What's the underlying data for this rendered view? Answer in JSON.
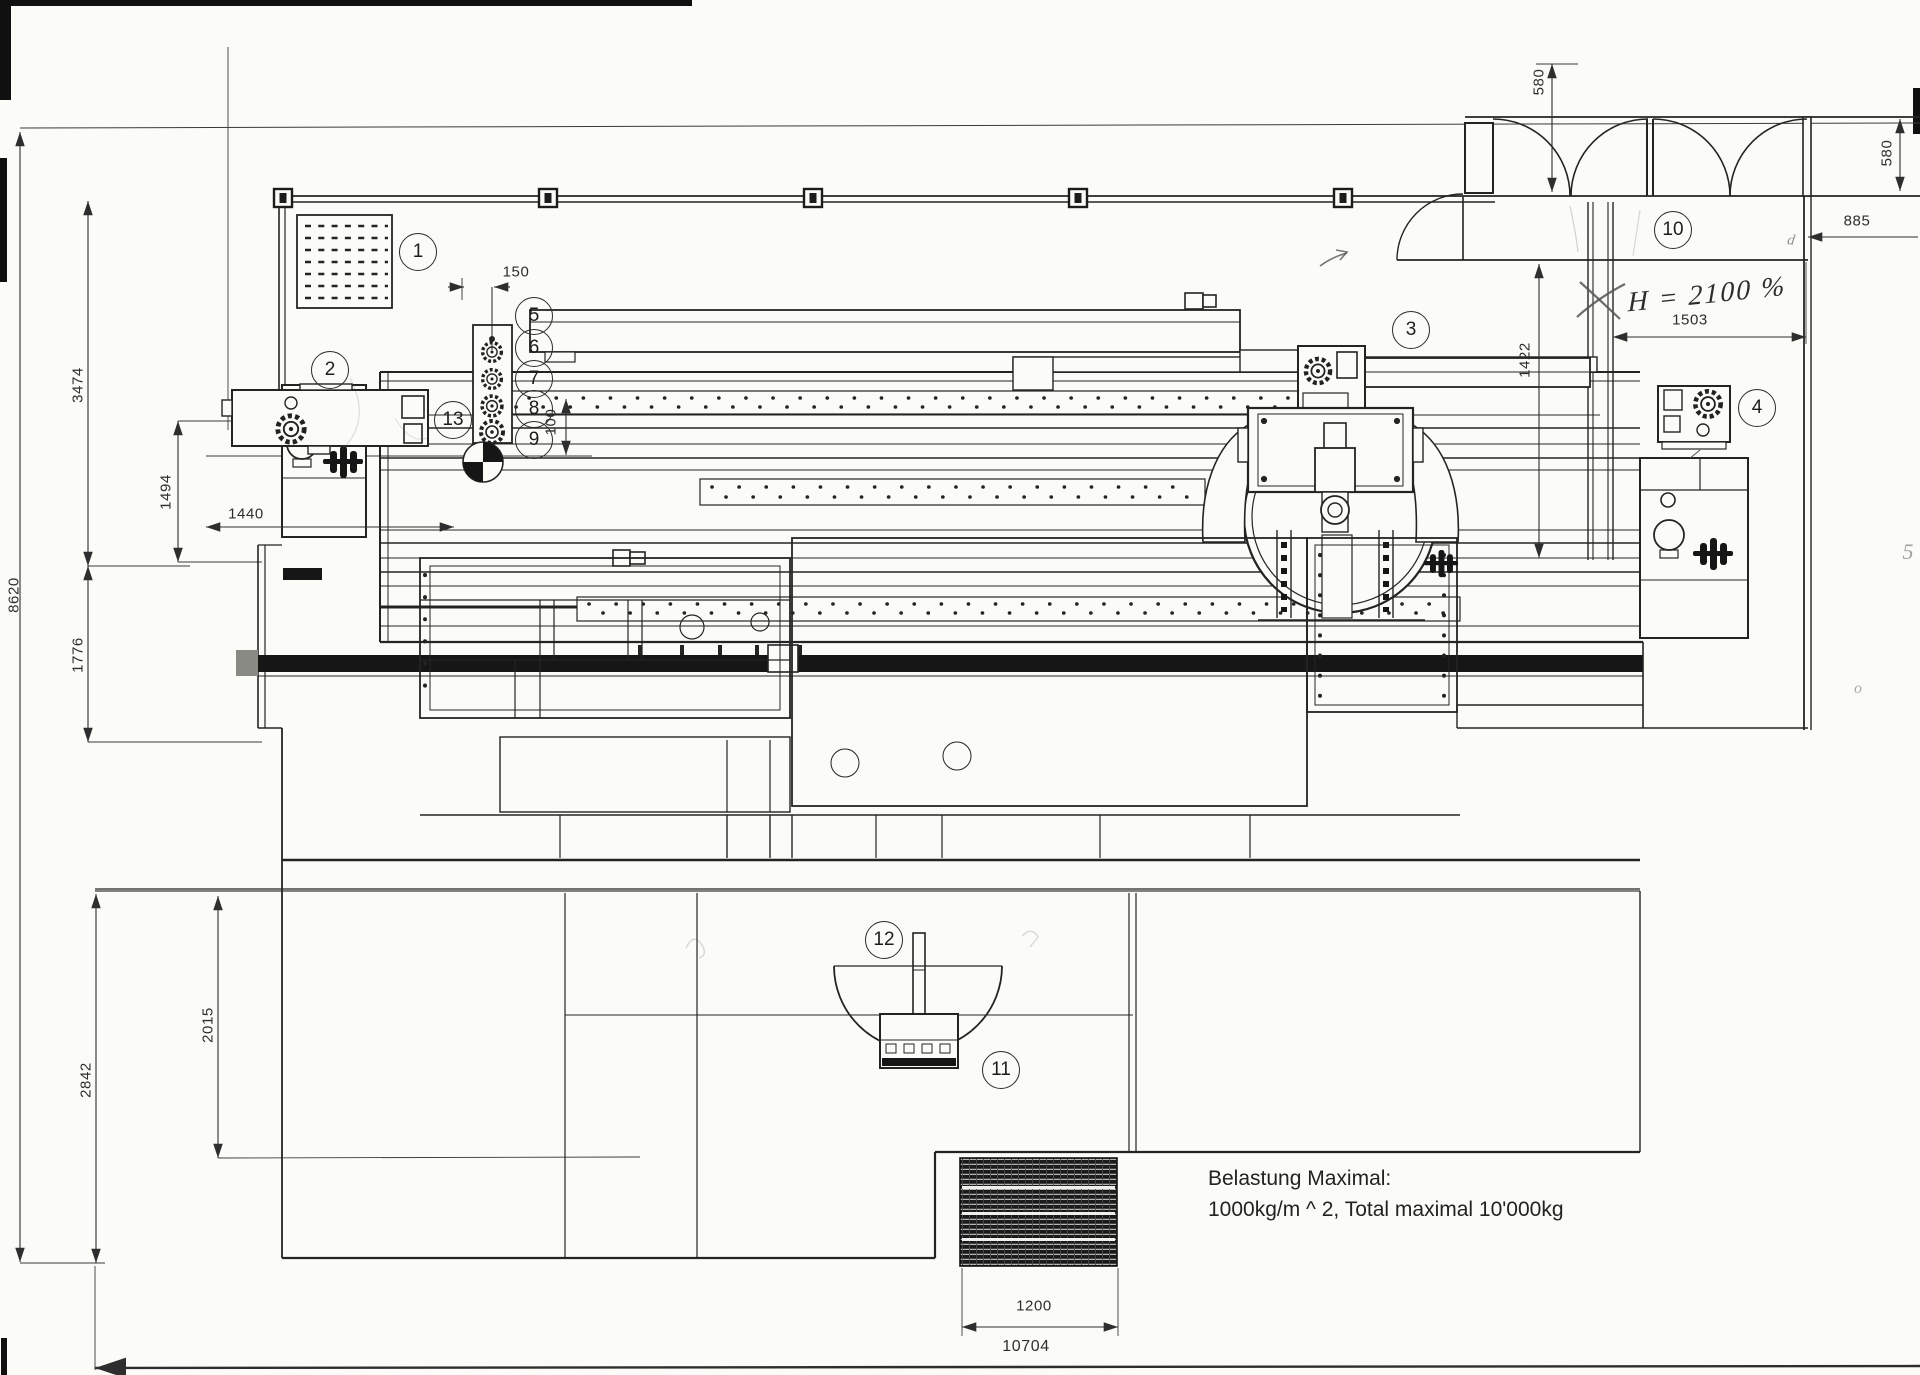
{
  "theme": {
    "paper": "#fbfbf8",
    "ink": "#242424",
    "dim": "#2e2e2e",
    "pencil": "#6f6f6f",
    "dark": "#161616"
  },
  "callouts": [
    {
      "n": "1"
    },
    {
      "n": "2"
    },
    {
      "n": "3"
    },
    {
      "n": "4"
    },
    {
      "n": "5"
    },
    {
      "n": "6"
    },
    {
      "n": "7"
    },
    {
      "n": "8"
    },
    {
      "n": "9"
    },
    {
      "n": "10"
    },
    {
      "n": "11"
    },
    {
      "n": "12"
    },
    {
      "n": "13"
    }
  ],
  "dimensions": {
    "d8620": "8620",
    "d3474": "3474",
    "d1776": "1776",
    "d2842": "2842",
    "d2015": "2015",
    "d1494": "1494",
    "d1440": "1440",
    "d150": "150",
    "d100": "100",
    "d580_top": "580",
    "d580_right": "580",
    "d885": "885",
    "d1503": "1503",
    "d1422": "1422",
    "d1200": "1200",
    "d10704": "10704"
  },
  "annotations": {
    "handwritten_note": "H = 2100 %",
    "pencil_mark_near_885": "d",
    "pencil_mark_near_right_wall": "o",
    "pencil_mark_right_edge": "5"
  },
  "load_note": {
    "line1": "Belastung Maximal:",
    "line2": "1000kg/m ^ 2, Total maximal 10'000kg"
  }
}
